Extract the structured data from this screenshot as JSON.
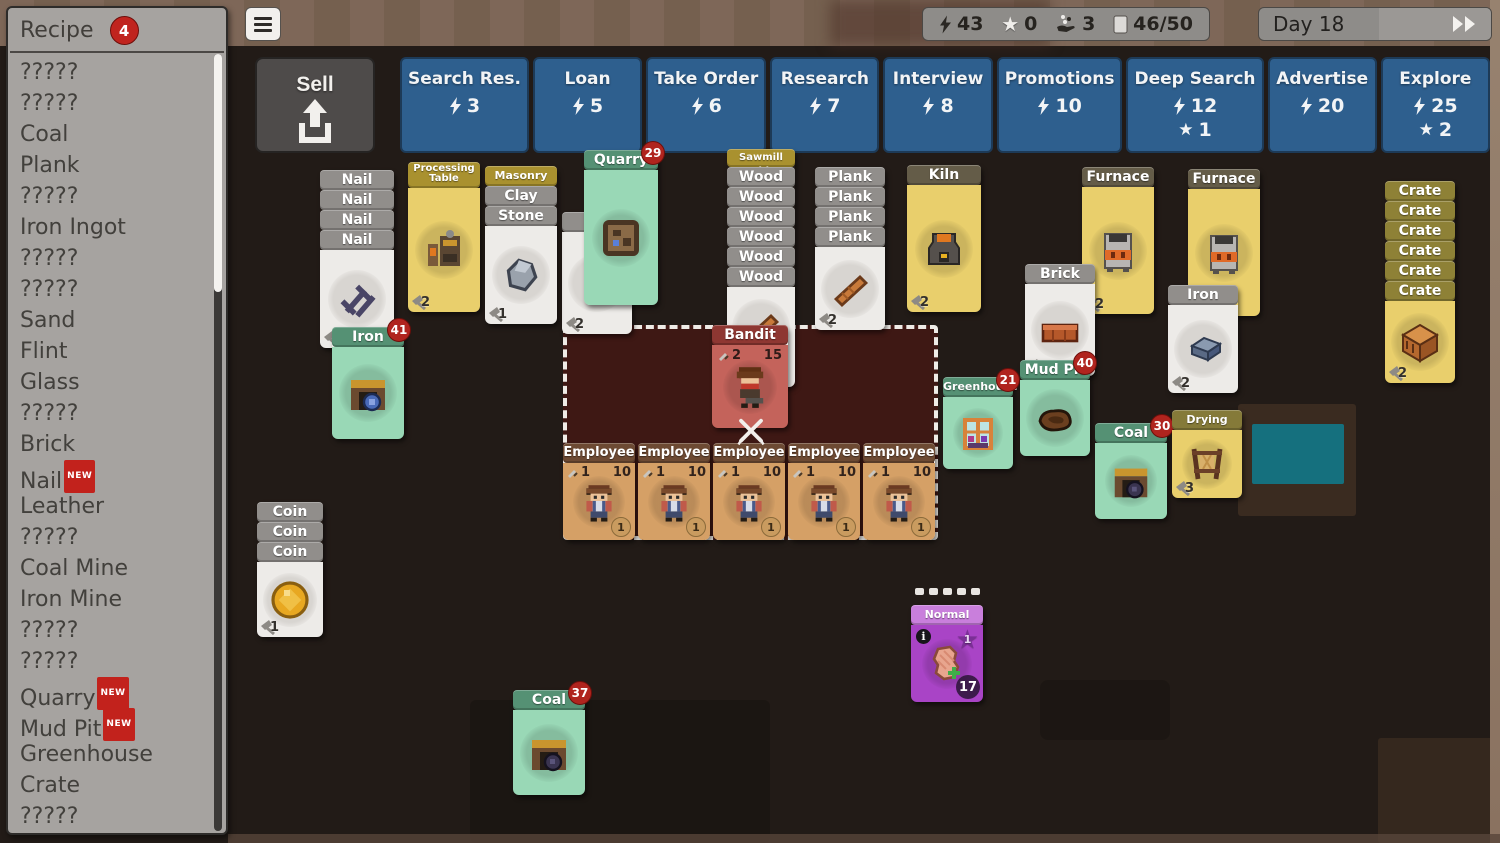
{
  "sidebar": {
    "title": "Recipe",
    "badge": "4",
    "items": [
      {
        "label": "?????",
        "tag": ""
      },
      {
        "label": "?????",
        "tag": ""
      },
      {
        "label": "Coal",
        "tag": ""
      },
      {
        "label": "Plank",
        "tag": ""
      },
      {
        "label": "?????",
        "tag": ""
      },
      {
        "label": "Iron Ingot",
        "tag": ""
      },
      {
        "label": "?????",
        "tag": ""
      },
      {
        "label": "?????",
        "tag": ""
      },
      {
        "label": "Sand",
        "tag": ""
      },
      {
        "label": "Flint",
        "tag": ""
      },
      {
        "label": "Glass",
        "tag": ""
      },
      {
        "label": "?????",
        "tag": ""
      },
      {
        "label": "Brick",
        "tag": ""
      },
      {
        "label": "Nail",
        "tag": "NEW"
      },
      {
        "label": "Leather",
        "tag": ""
      },
      {
        "label": "?????",
        "tag": ""
      },
      {
        "label": "Coal Mine",
        "tag": ""
      },
      {
        "label": "Iron Mine",
        "tag": ""
      },
      {
        "label": "?????",
        "tag": ""
      },
      {
        "label": "?????",
        "tag": ""
      },
      {
        "label": "Quarry",
        "tag": "NEW"
      },
      {
        "label": "Mud Pit",
        "tag": "NEW"
      },
      {
        "label": "Greenhouse",
        "tag": ""
      },
      {
        "label": "Crate",
        "tag": ""
      },
      {
        "label": "?????",
        "tag": ""
      }
    ]
  },
  "topbar": {
    "sell_label": "Sell",
    "actions": [
      {
        "label": "Search Res.",
        "energy": "3",
        "star": ""
      },
      {
        "label": "Loan",
        "energy": "5",
        "star": ""
      },
      {
        "label": "Take Order",
        "energy": "6",
        "star": ""
      },
      {
        "label": "Research",
        "energy": "7",
        "star": ""
      },
      {
        "label": "Interview",
        "energy": "8",
        "star": ""
      },
      {
        "label": "Promotions",
        "energy": "10",
        "star": ""
      },
      {
        "label": "Deep Search",
        "energy": "12",
        "star": "1"
      },
      {
        "label": "Advertise",
        "energy": "20",
        "star": ""
      },
      {
        "label": "Explore",
        "energy": "25",
        "star": "2"
      }
    ],
    "status": {
      "energy": "43",
      "stars": "0",
      "deals": "3",
      "cards": "46/50"
    },
    "day": {
      "label": "Day 18"
    }
  },
  "icons": {
    "menu": "hamburger-icon",
    "sell": "upload-arrow-icon",
    "energy": "lightning-bolt-icon",
    "star": "star-icon",
    "deals": "hand-with-items-icon",
    "cards": "card-stack-icon",
    "fast_forward": "double-arrow-icon",
    "battle": "crossed-swords-icon",
    "attack": "dagger-icon",
    "value": "hammer-icon",
    "info": "info-circle-icon"
  },
  "board": {
    "nail": {
      "title": "Nail",
      "value": "1"
    },
    "processing_table": {
      "title": "Processing Table",
      "value": "2"
    },
    "masonry_table": {
      "title": "Masonry Table",
      "clay": "Clay",
      "stone": "Stone",
      "value": "1"
    },
    "quarry": {
      "title": "Quarry",
      "badge": "29"
    },
    "flint": {
      "value": "2"
    },
    "sawmill": {
      "title": "Sawmill Table",
      "wood_label": "Wood"
    },
    "plank": {
      "title": "Plank",
      "value": "2"
    },
    "kiln": {
      "title": "Kiln",
      "value": "2"
    },
    "furnace1": {
      "title": "Furnace",
      "value": "2"
    },
    "furnace2": {
      "title": "Furnace",
      "value": "2"
    },
    "crate": {
      "title": "Crate",
      "value": "2"
    },
    "iron_mine": {
      "title": "Iron Mine",
      "badge": "41"
    },
    "brick": {
      "title": "Brick",
      "value": "2"
    },
    "iron_ingot": {
      "title": "Iron Ingot",
      "value": "2"
    },
    "greenhouse": {
      "title": "Greenhouse",
      "badge": "21"
    },
    "mud_pit": {
      "title": "Mud Pit",
      "badge": "40"
    },
    "coal_mine_right": {
      "title": "Coal Mine",
      "badge": "30"
    },
    "drying_rack": {
      "title": "Drying Rack",
      "value": "3"
    },
    "bandit": {
      "title": "Bandit",
      "attack": "2",
      "hp": "15"
    },
    "employees": [
      {
        "title": "Employee",
        "attack": "1",
        "hp": "10",
        "wage": "1"
      },
      {
        "title": "Employee",
        "attack": "1",
        "hp": "10",
        "wage": "1"
      },
      {
        "title": "Employee",
        "attack": "1",
        "hp": "10",
        "wage": "1"
      },
      {
        "title": "Employee",
        "attack": "1",
        "hp": "10",
        "wage": "1"
      },
      {
        "title": "Employee",
        "attack": "1",
        "hp": "10",
        "wage": "1"
      }
    ],
    "coin": {
      "title": "Coin",
      "value": "1"
    },
    "normal_order": {
      "title": "Normal Order",
      "star": "1",
      "count": "17"
    },
    "coal_mine_bottom": {
      "title": "Coal Mine",
      "badge": "37"
    }
  },
  "colors": {
    "accent_blue": "#2e5f8e",
    "card_green": "#99d8b6",
    "card_yellow": "#e9cf6c",
    "badge_red": "#b0241e",
    "order_purple": "#a944c6"
  }
}
